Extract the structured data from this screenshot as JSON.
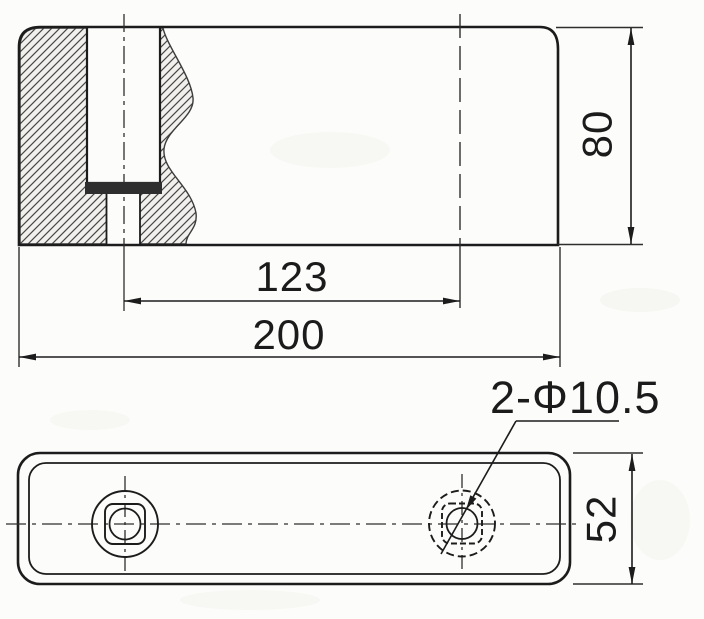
{
  "drawing": {
    "type": "engineering-drawing",
    "colors": {
      "ink": "#1c1c1c",
      "paper": "#fcfcfa",
      "hatch_line": "#474747",
      "insert_fill": "#2e2e2e"
    },
    "section_view": {
      "description": "side section view with cross-hatched broken-out section",
      "dim_hole_spacing": "123",
      "dim_overall_length": "200",
      "dim_height": "80"
    },
    "plan_view": {
      "description": "bottom plan view of base plate with two square-in-circle holes",
      "dim_plate_width": "52",
      "holes_label": "2-Φ10.5"
    }
  }
}
